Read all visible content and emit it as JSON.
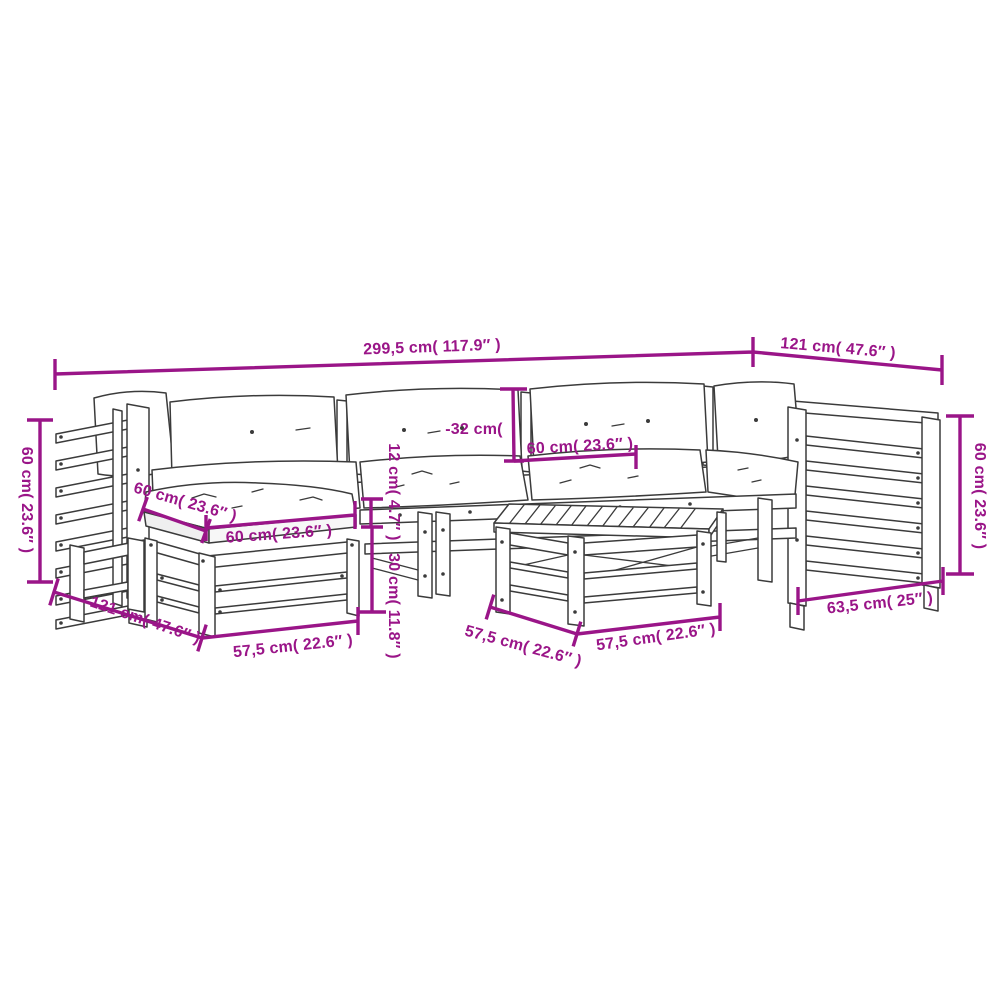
{
  "page": {
    "background": "#ffffff"
  },
  "diagram": {
    "type": "product-dimension-line-drawing",
    "subject": "7-piece wooden garden lounge sofa set with cushions, ottoman and coffee table",
    "dimension_color": "#9a1588",
    "line_color": "#3b3b3b"
  },
  "labels": {
    "total_width": "299,5 cm( 117.9″ )",
    "corner_depth_top": "121 cm( 47.6″ )",
    "back_height_left": "60 cm( 23.6″ )",
    "seat_depth_left": "60 cm( 23.6″ )",
    "cushion_width_left": "60 cm( 23.6″ )",
    "back_cushion_height": "-32 cm(",
    "cushion_width_center": "60 cm( 23.6″ )",
    "cushion_thickness": "12 cm( 4.7″ )",
    "seat_height": "30 cm( 11.8″ )",
    "corner_depth_bottom": "121 cm( 47.6″ )",
    "ottoman_width": "57,5 cm( 22.6″ )",
    "table_depth": "57,5 cm( 22.6″ )",
    "table_width": "57,5 cm( 22.6″ )",
    "right_module_width": "63,5 cm( 25″ )",
    "back_height_right": "60 cm( 23.6″ )"
  }
}
